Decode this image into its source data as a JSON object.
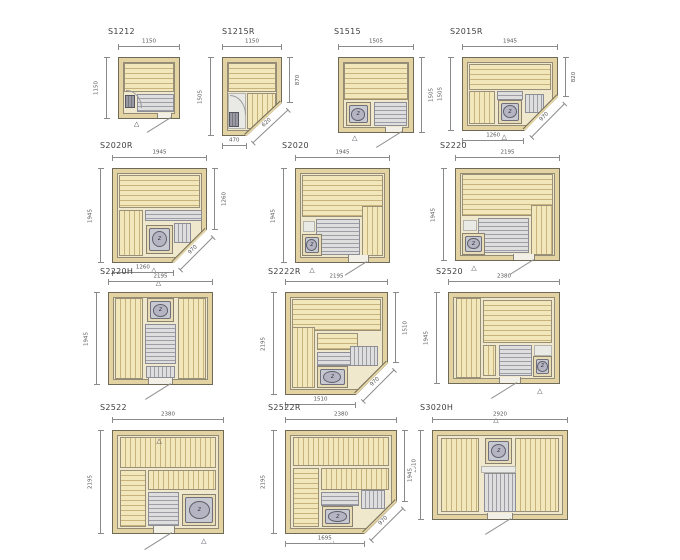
{
  "icons": {
    "vent": "△",
    "heater": "z"
  },
  "colors": {
    "wood": "#f2e6bb",
    "wood_line": "#c7b37b",
    "wall": "#e3d3a2",
    "floor_gray": "#9e9ea6",
    "outline": "#6e6a57"
  },
  "plans": [
    {
      "id": "s1212",
      "title": "S1212",
      "box": {
        "x": 118,
        "y": 57,
        "w": 62,
        "h": 62,
        "tx": 108,
        "ty": 28
      },
      "dims": {
        "top": "1150",
        "left": "1150"
      },
      "features": [
        {
          "k": "bench-h",
          "r": [
            8,
            8,
            84,
            48
          ]
        },
        {
          "k": "floor-h",
          "r": [
            30,
            60,
            62,
            30
          ]
        },
        {
          "k": "heater-sq",
          "r": [
            10,
            62,
            16,
            22
          ]
        },
        {
          "k": "arc",
          "r": [
            12,
            54,
            26,
            30
          ]
        },
        {
          "k": "door",
          "r": [
            64,
            92,
            24,
            8
          ]
        },
        {
          "k": "vent",
          "r": [
            30,
            104
          ]
        },
        {
          "k": "swing",
          "r": [
            86,
            99
          ],
          "a": 148,
          "len": 28
        }
      ]
    },
    {
      "id": "s1215r",
      "title": "S1215R",
      "box": {
        "x": 222,
        "y": 57,
        "w": 60,
        "h": 79,
        "tx": 222,
        "ty": 28
      },
      "dims": {
        "top": "1150",
        "left": "1505",
        "right": {
          "label": "870",
          "span": 58
        },
        "bottom": {
          "label": "470",
          "span": 41
        },
        "diag": {
          "label": "620"
        }
      },
      "cut": {
        "bx": 41,
        "ry": 58
      },
      "features": [
        {
          "k": "bench-h",
          "r": [
            8,
            6,
            84,
            38
          ]
        },
        {
          "k": "white",
          "r": [
            8,
            46,
            32,
            46
          ]
        },
        {
          "k": "bench-v",
          "r": [
            42,
            46,
            50,
            46
          ]
        },
        {
          "k": "heater-sq",
          "r": [
            10,
            70,
            18,
            20
          ]
        },
        {
          "k": "arc",
          "r": [
            12,
            48,
            28,
            26
          ]
        },
        {
          "k": "vent",
          "r": [
            20,
            103
          ]
        }
      ]
    },
    {
      "id": "s1515",
      "title": "S1515",
      "box": {
        "x": 338,
        "y": 57,
        "w": 76,
        "h": 76,
        "tx": 334,
        "ty": 28
      },
      "dims": {
        "top": "1505",
        "right": {
          "label": "1505",
          "span": 100
        }
      },
      "features": [
        {
          "k": "bench-h",
          "r": [
            7,
            7,
            86,
            50
          ]
        },
        {
          "k": "heater",
          "r": [
            9,
            60,
            34,
            32
          ]
        },
        {
          "k": "floor-h",
          "r": [
            47,
            60,
            45,
            32
          ]
        },
        {
          "k": "door",
          "r": [
            62,
            93,
            24,
            7
          ]
        },
        {
          "k": "vent",
          "r": [
            22,
            103
          ]
        },
        {
          "k": "swing",
          "r": [
            84,
            99
          ],
          "a": 148,
          "len": 30
        }
      ]
    },
    {
      "id": "s2015r",
      "title": "S2015R",
      "box": {
        "x": 462,
        "y": 57,
        "w": 96,
        "h": 74,
        "tx": 450,
        "ty": 28
      },
      "dims": {
        "top": "1945",
        "left": "1505",
        "right": {
          "label": "820",
          "span": 54
        },
        "bottom": {
          "label": "1260",
          "span": 65
        },
        "diag": {
          "label": "970"
        }
      },
      "cut": {
        "bx": 65,
        "ry": 54
      },
      "features": [
        {
          "k": "bench-h",
          "r": [
            6,
            8,
            88,
            36
          ]
        },
        {
          "k": "bench-v",
          "r": [
            6,
            46,
            28,
            46
          ]
        },
        {
          "k": "floor-h",
          "r": [
            36,
            46,
            28,
            12
          ]
        },
        {
          "k": "heater",
          "r": [
            37,
            58,
            26,
            33
          ]
        },
        {
          "k": "floor-v",
          "r": [
            66,
            50,
            20,
            26
          ]
        },
        {
          "k": "vent",
          "r": [
            44,
            104
          ]
        }
      ]
    },
    {
      "id": "s2020r",
      "title": "S2020R",
      "box": {
        "x": 112,
        "y": 168,
        "w": 95,
        "h": 95,
        "tx": 100,
        "ty": 142
      },
      "dims": {
        "top": "1945",
        "left": "1945",
        "right": {
          "label": "1260",
          "span": 65
        },
        "bottom": {
          "label": "1260",
          "span": 65
        },
        "diag": {
          "label": "970"
        }
      },
      "cut": {
        "bx": 65,
        "ry": 65
      },
      "features": [
        {
          "k": "bench-h",
          "r": [
            6,
            6,
            88,
            36
          ]
        },
        {
          "k": "bench-v",
          "r": [
            6,
            44,
            26,
            50
          ]
        },
        {
          "k": "floor-h",
          "r": [
            34,
            44,
            62,
            12
          ]
        },
        {
          "k": "heater",
          "r": [
            36,
            60,
            28,
            31
          ]
        },
        {
          "k": "floor-v",
          "r": [
            66,
            58,
            18,
            22
          ]
        },
        {
          "k": "vent",
          "r": [
            44,
            104
          ]
        }
      ]
    },
    {
      "id": "s2020",
      "title": "S2020",
      "box": {
        "x": 295,
        "y": 168,
        "w": 95,
        "h": 95,
        "tx": 282,
        "ty": 142
      },
      "dims": {
        "top": "1945",
        "left": "1945"
      },
      "features": [
        {
          "k": "bench-h",
          "r": [
            6,
            6,
            88,
            46
          ]
        },
        {
          "k": "bench-v",
          "r": [
            71,
            40,
            23,
            54
          ]
        },
        {
          "k": "floor-h",
          "r": [
            21,
            54,
            48,
            38
          ]
        },
        {
          "k": "white",
          "r": [
            7,
            56,
            13,
            12
          ]
        },
        {
          "k": "heater",
          "r": [
            6,
            70,
            22,
            24
          ]
        },
        {
          "k": "door",
          "r": [
            56,
            93,
            22,
            7
          ]
        },
        {
          "k": "vent",
          "r": [
            18,
            104
          ]
        },
        {
          "k": "swing",
          "r": [
            76,
            99
          ],
          "a": 148,
          "len": 32
        }
      ]
    },
    {
      "id": "s2220",
      "title": "S2220",
      "box": {
        "x": 455,
        "y": 168,
        "w": 105,
        "h": 93,
        "tx": 440,
        "ty": 142
      },
      "dims": {
        "top": "2195",
        "left": "1945"
      },
      "features": [
        {
          "k": "bench-h",
          "r": [
            6,
            6,
            88,
            46
          ]
        },
        {
          "k": "bench-v",
          "r": [
            73,
            40,
            21,
            54
          ]
        },
        {
          "k": "floor-h",
          "r": [
            21,
            54,
            50,
            38
          ]
        },
        {
          "k": "white",
          "r": [
            7,
            56,
            13,
            12
          ]
        },
        {
          "k": "heater",
          "r": [
            6,
            70,
            22,
            24
          ]
        },
        {
          "k": "door",
          "r": [
            55,
            93,
            22,
            7
          ]
        },
        {
          "k": "vent",
          "r": [
            18,
            104
          ]
        },
        {
          "k": "swing",
          "r": [
            75,
            99
          ],
          "a": 148,
          "len": 32
        }
      ]
    },
    {
      "id": "s2220h",
      "title": "S2220H",
      "box": {
        "x": 108,
        "y": 292,
        "w": 105,
        "h": 93,
        "tx": 100,
        "ty": 268
      },
      "dims": {
        "top": "2195",
        "left": "1945"
      },
      "features": [
        {
          "k": "bench-v",
          "r": [
            6,
            6,
            27,
            88
          ]
        },
        {
          "k": "bench-v",
          "r": [
            67,
            6,
            27,
            88
          ]
        },
        {
          "k": "heater",
          "r": [
            37,
            6,
            26,
            26
          ]
        },
        {
          "k": "floor-h",
          "r": [
            35,
            34,
            30,
            44
          ]
        },
        {
          "k": "floor-v",
          "r": [
            36,
            80,
            28,
            13
          ]
        },
        {
          "k": "door",
          "r": [
            38,
            93,
            24,
            7
          ]
        },
        {
          "k": "vent",
          "r": [
            48,
            -13
          ]
        },
        {
          "k": "swing",
          "r": [
            60,
            99
          ],
          "a": 148,
          "len": 30
        }
      ]
    },
    {
      "id": "s2222r",
      "title": "S2222R",
      "box": {
        "x": 285,
        "y": 292,
        "w": 103,
        "h": 103,
        "tx": 268,
        "ty": 268
      },
      "dims": {
        "top": "2195",
        "left": "2195",
        "right": {
          "label": "1510",
          "span": 69
        },
        "bottom": {
          "label": "1510",
          "span": 69
        },
        "diag": {
          "label": "970"
        }
      },
      "cut": {
        "bx": 69,
        "ry": 69
      },
      "features": [
        {
          "k": "bench-h",
          "r": [
            6,
            6,
            88,
            32
          ]
        },
        {
          "k": "bench-v",
          "r": [
            6,
            34,
            23,
            60
          ]
        },
        {
          "k": "bench-h",
          "r": [
            31,
            40,
            40,
            16
          ]
        },
        {
          "k": "floor-h",
          "r": [
            31,
            58,
            36,
            14
          ]
        },
        {
          "k": "heater",
          "r": [
            31,
            72,
            30,
            22
          ]
        },
        {
          "k": "floor-v",
          "r": [
            63,
            52,
            28,
            20
          ]
        },
        {
          "k": "vent",
          "r": [
            40,
            104
          ]
        }
      ]
    },
    {
      "id": "s2520",
      "title": "S2520",
      "box": {
        "x": 448,
        "y": 292,
        "w": 112,
        "h": 92,
        "tx": 436,
        "ty": 268
      },
      "dims": {
        "top": "2380",
        "left": "1945"
      },
      "features": [
        {
          "k": "bench-v",
          "r": [
            6,
            6,
            23,
            88
          ]
        },
        {
          "k": "bench-h",
          "r": [
            31,
            8,
            63,
            48
          ]
        },
        {
          "k": "bench-v",
          "r": [
            31,
            58,
            12,
            34
          ]
        },
        {
          "k": "floor-h",
          "r": [
            45,
            58,
            30,
            34
          ]
        },
        {
          "k": "white",
          "r": [
            77,
            58,
            17,
            12
          ]
        },
        {
          "k": "heater",
          "r": [
            76,
            70,
            18,
            23
          ]
        },
        {
          "k": "door",
          "r": [
            45,
            93,
            20,
            7
          ]
        },
        {
          "k": "vent",
          "r": [
            82,
            104
          ]
        },
        {
          "k": "swing",
          "r": [
            62,
            99
          ],
          "a": 148,
          "len": 30
        }
      ]
    },
    {
      "id": "s2522",
      "title": "S2522",
      "box": {
        "x": 112,
        "y": 430,
        "w": 112,
        "h": 104,
        "tx": 100,
        "ty": 404
      },
      "dims": {
        "top": "2380",
        "left": "2195"
      },
      "features": [
        {
          "k": "bench-v",
          "r": [
            6,
            6,
            88,
            30
          ]
        },
        {
          "k": "bench-h",
          "r": [
            6,
            38,
            24,
            56
          ]
        },
        {
          "k": "bench-v",
          "r": [
            32,
            38,
            62,
            20
          ]
        },
        {
          "k": "floor-h",
          "r": [
            32,
            60,
            28,
            33
          ]
        },
        {
          "k": "heater",
          "r": [
            63,
            62,
            31,
            31
          ]
        },
        {
          "k": "door",
          "r": [
            36,
            93,
            20,
            7
          ]
        },
        {
          "k": "vent",
          "r": [
            42,
            8
          ]
        },
        {
          "k": "vent",
          "r": [
            82,
            104
          ]
        },
        {
          "k": "swing",
          "r": [
            54,
            99
          ],
          "a": 148,
          "len": 32
        }
      ]
    },
    {
      "id": "s2522r",
      "title": "S2522R",
      "box": {
        "x": 285,
        "y": 430,
        "w": 112,
        "h": 104,
        "tx": 268,
        "ty": 404
      },
      "dims": {
        "top": "2380",
        "left": "2195",
        "right": {
          "label": "1510",
          "span": 69
        },
        "bottom": {
          "label": "1695",
          "span": 71
        },
        "diag": {
          "label": "970"
        }
      },
      "cut": {
        "bx": 71,
        "ry": 69
      },
      "features": [
        {
          "k": "bench-v",
          "r": [
            6,
            6,
            88,
            28
          ]
        },
        {
          "k": "bench-h",
          "r": [
            6,
            36,
            24,
            58
          ]
        },
        {
          "k": "bench-v",
          "r": [
            32,
            36,
            62,
            22
          ]
        },
        {
          "k": "floor-h",
          "r": [
            32,
            60,
            34,
            14
          ]
        },
        {
          "k": "heater",
          "r": [
            33,
            74,
            28,
            20
          ]
        },
        {
          "k": "floor-v",
          "r": [
            68,
            58,
            22,
            18
          ]
        },
        {
          "k": "vent",
          "r": [
            42,
            104
          ]
        }
      ]
    },
    {
      "id": "s3020h",
      "title": "S3020H",
      "box": {
        "x": 432,
        "y": 430,
        "w": 136,
        "h": 90,
        "tx": 420,
        "ty": 404
      },
      "dims": {
        "top": "2920",
        "left": "1945"
      },
      "features": [
        {
          "k": "bench-v",
          "r": [
            6,
            8,
            28,
            84
          ]
        },
        {
          "k": "bench-v",
          "r": [
            61,
            8,
            33,
            84
          ]
        },
        {
          "k": "heater",
          "r": [
            39,
            8,
            20,
            30
          ]
        },
        {
          "k": "white",
          "r": [
            36,
            40,
            26,
            8
          ]
        },
        {
          "k": "floor-v",
          "r": [
            38,
            48,
            24,
            44
          ]
        },
        {
          "k": "door",
          "r": [
            40,
            93,
            20,
            7
          ]
        },
        {
          "k": "vent",
          "r": [
            47,
            -14
          ]
        },
        {
          "k": "swing",
          "r": [
            58,
            99
          ],
          "a": 148,
          "len": 30
        }
      ]
    }
  ]
}
